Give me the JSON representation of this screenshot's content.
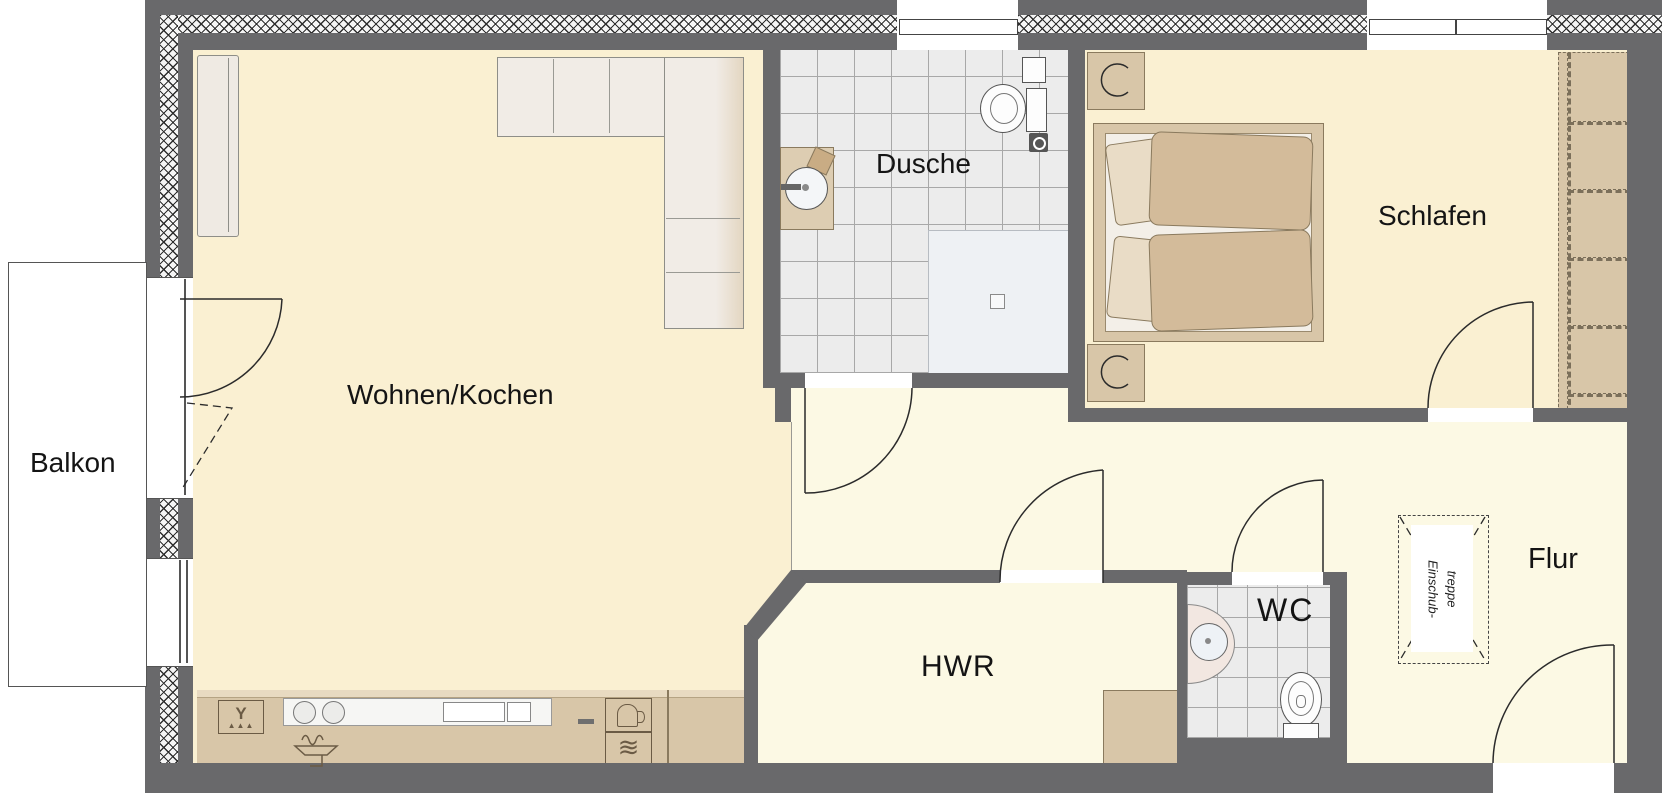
{
  "rooms": {
    "balkon": {
      "label": "Balkon"
    },
    "wohnen_kochen": {
      "label": "Wohnen/Kochen"
    },
    "dusche": {
      "label": "Dusche"
    },
    "schlafen": {
      "label": "Schlafen"
    },
    "hwr": {
      "label": "HWR"
    },
    "wc": {
      "label": "WC"
    },
    "flur": {
      "label": "Flur"
    }
  },
  "annotations": {
    "attic_stairs": {
      "line1": "Einschub-",
      "line2": "treppe"
    }
  },
  "symbols": {
    "dishwasher_glyph": "Y",
    "dishwasher_drops": "▲▲▲",
    "oven_steam_glyph": "≋"
  },
  "colors": {
    "wall": "#69696b",
    "floor_living": "#faf0d2",
    "floor_hall": "#fcf9e4",
    "tile": "#ececec",
    "grout": "#a8a8a8",
    "furniture": "#d8c6a8",
    "furniture_dark": "#8a7a5e",
    "counter_trim": "#e8dac1",
    "fixture_white": "#fdfdfd",
    "shower_tray": "#eef1f4",
    "sofa": "#f1ece6",
    "pillow": "#e9dcc6",
    "blanket": "#d3bb9a",
    "basin_pink": "#f2e7e1",
    "line": "#2b2b2b",
    "symbol": "#6b5b45"
  }
}
